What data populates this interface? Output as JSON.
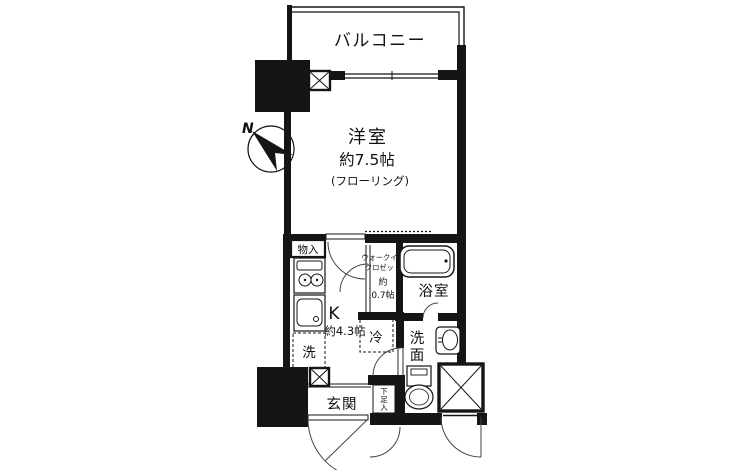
{
  "plan": {
    "balcony_label": "バルコニー",
    "compass_label": "N",
    "main_room": {
      "name": "洋室",
      "size": "約7.5帖",
      "flooring": "(フローリング)"
    },
    "storage_label": "物入",
    "kitchen": {
      "type": "K",
      "size": "約4.3帖"
    },
    "wic": {
      "line1": "ウォークイン",
      "line2": "クロゼット",
      "line3": "約",
      "line4": "0.7帖"
    },
    "bath_label": "浴室",
    "fridge_label": "冷",
    "laundry_label": "洗",
    "washroom": {
      "char1": "洗",
      "char2": "面"
    },
    "entrance_label": "玄関",
    "shoe_box": {
      "char1": "下",
      "char2": "足",
      "char3": "入"
    },
    "colors": {
      "line": "#151515",
      "bg": "#ffffff"
    }
  }
}
